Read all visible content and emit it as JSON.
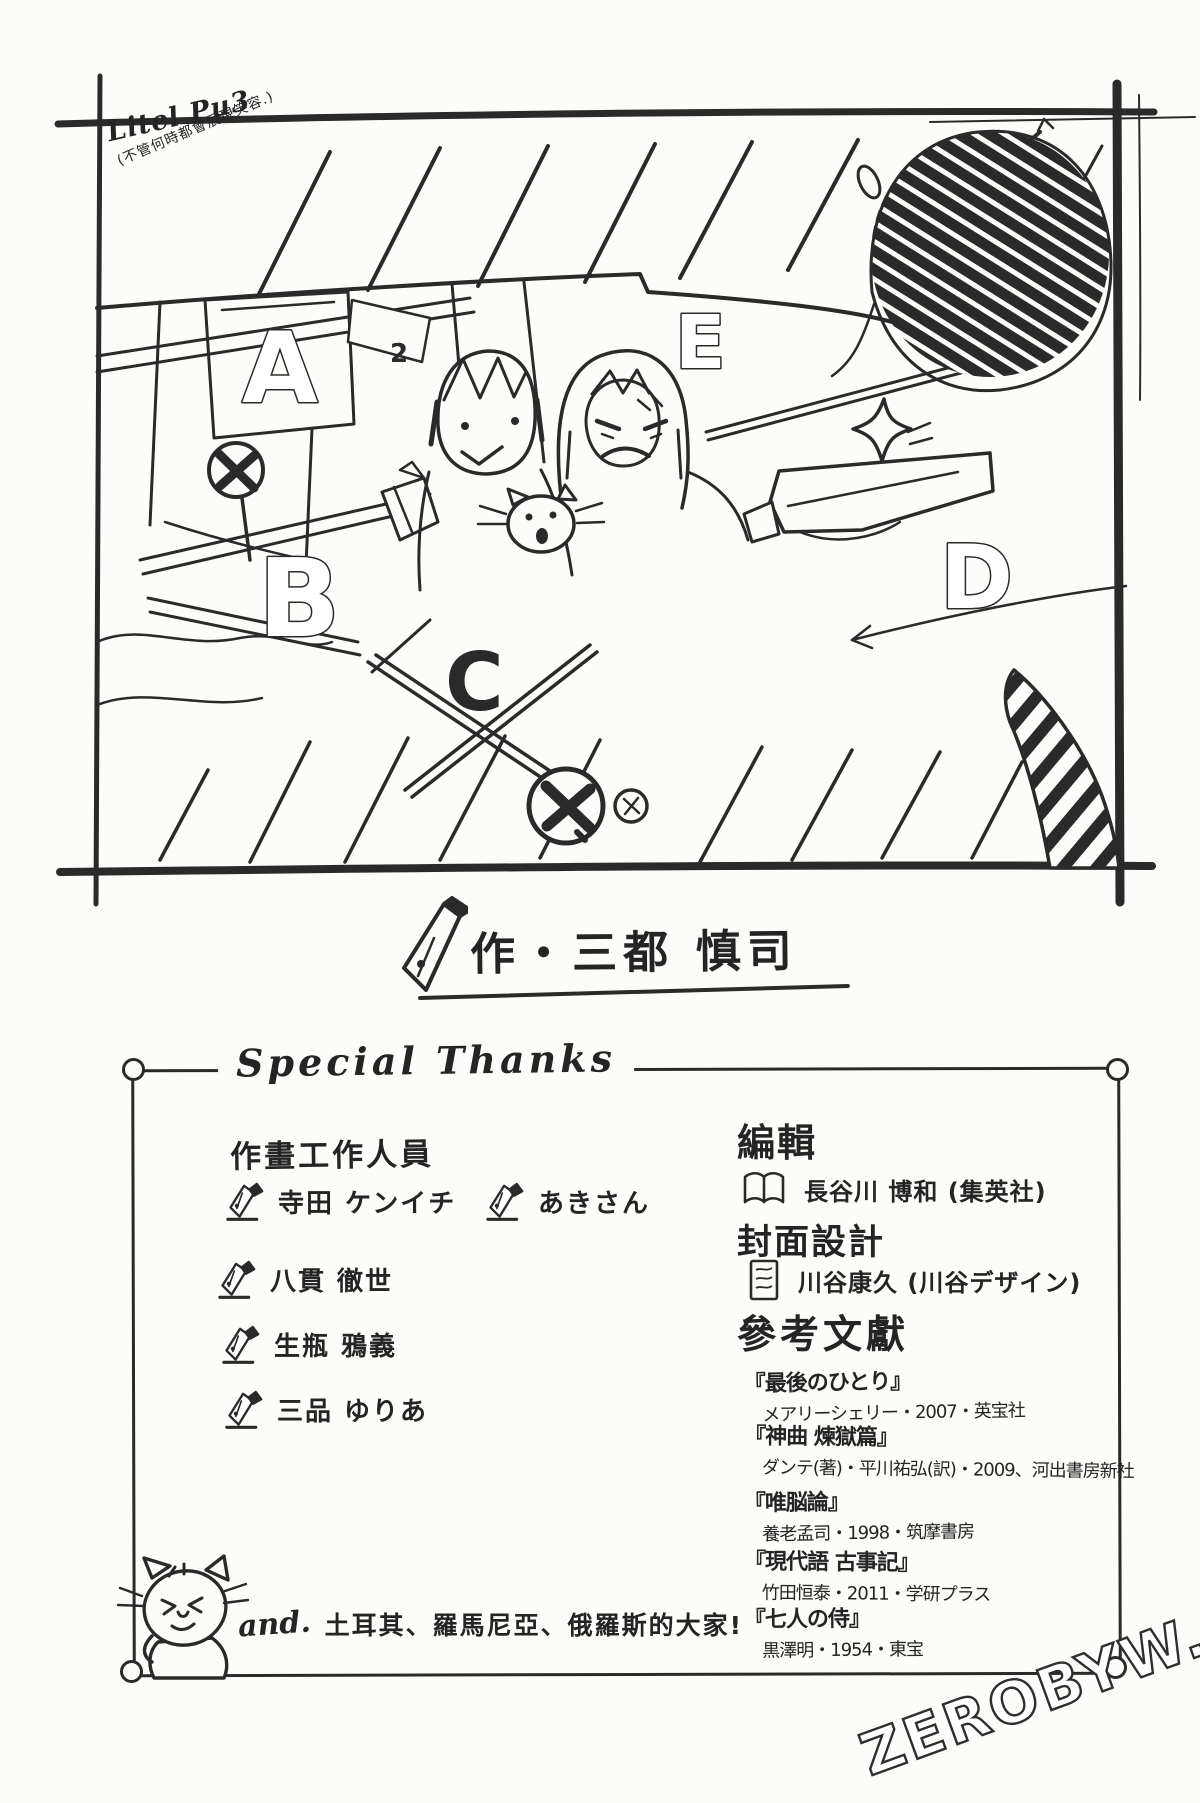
{
  "page": {
    "paper_color": "#fcfcf9",
    "ink_color": "#2a2a2a",
    "watermark": "ZEROBYW.COM"
  },
  "sketch": {
    "signature": "Litel Pu3",
    "signature_note": "(不管何時都會展現笑容.)",
    "panel_labels": [
      "A",
      "B",
      "C",
      "D",
      "E"
    ],
    "number_label": "2"
  },
  "author_line": {
    "text": "作・三都 慎司"
  },
  "thanks_box": {
    "title": "Special Thanks",
    "staff": {
      "header": "作畫工作人員",
      "names": [
        "寺田 ケンイチ",
        "あきさん",
        "八貫 徹世",
        "生瓶 鴉義",
        "三品 ゆりあ"
      ]
    },
    "editor": {
      "header": "編輯",
      "name": "長谷川 博和 (集英社)"
    },
    "cover_design": {
      "header": "封面設計",
      "name": "川谷康久 (川谷デザイン)"
    },
    "references": {
      "header": "參考文獻",
      "items": [
        {
          "title": "『最後のひとり』",
          "detail": "メアリーシェリー・2007・英宝社"
        },
        {
          "title": "『神曲 煉獄篇』",
          "detail": "ダンテ(著)・平川祐弘(訳)・2009、河出書房新社"
        },
        {
          "title": "『唯脳論』",
          "detail": "養老孟司・1998・筑摩書房"
        },
        {
          "title": "『現代語 古事記』",
          "detail": "竹田恒泰・2011・学研プラス"
        },
        {
          "title": "『七人の侍』",
          "detail": "黒澤明・1954・東宝"
        }
      ]
    },
    "extra": {
      "prefix": "and.",
      "text": "土耳其、羅馬尼亞、俄羅斯的大家!"
    }
  }
}
